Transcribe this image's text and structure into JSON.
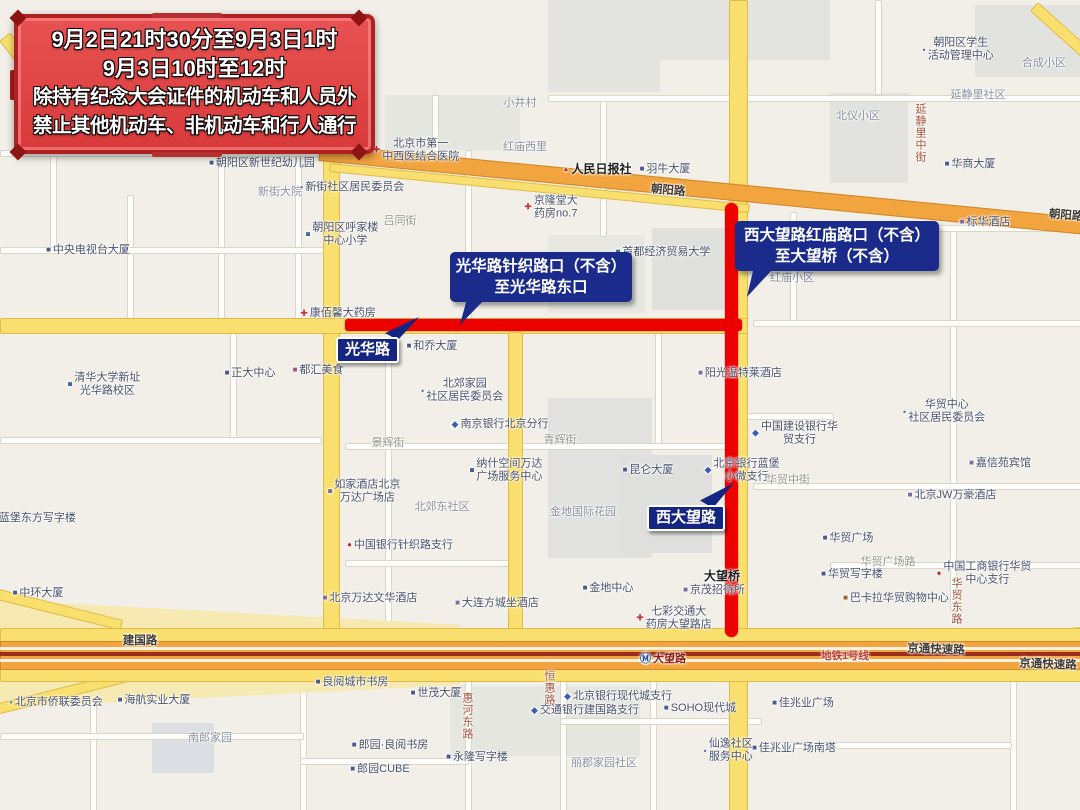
{
  "banner": {
    "lines": [
      "9月2日21时30分至9月3日1时",
      "9月3日10时至12时",
      "除持有纪念大会证件的机动车和人员外",
      "禁止其他机动车、非机动车和行人通行"
    ]
  },
  "callouts": [
    {
      "lines": [
        "光华路针织路口（不含）",
        "至光华路东口"
      ]
    },
    {
      "lines": [
        "西大望路红庙路口（不含）",
        "至大望桥（不含）"
      ]
    }
  ],
  "road_badges": [
    {
      "label": "光华路"
    },
    {
      "label": "西大望路"
    }
  ],
  "colors": {
    "restriction_red": "#EC0000",
    "callout_blue": "#1A2B8C",
    "banner_fill": "#DF4343",
    "banner_frame": "#B02222",
    "road_yellow": "#F9DF6E",
    "road_orange": "#F2A43F",
    "subway_line_red": "#9B2D1F"
  },
  "map": {
    "labels": [
      {
        "text": "朝阳区新世纪幼儿园",
        "x": 262,
        "y": 163,
        "type": "poi",
        "icon": "building"
      },
      {
        "text": "新街大院",
        "x": 280,
        "y": 192,
        "type": "area"
      },
      {
        "text": "新街社区居民委员会",
        "x": 352,
        "y": 187,
        "type": "poi",
        "icon": "dot"
      },
      {
        "text": "中央电视台大厦",
        "x": 88,
        "y": 250,
        "type": "poi",
        "icon": "building"
      },
      {
        "text": "朝阳区呼家楼\n中心小学",
        "x": 342,
        "y": 234,
        "type": "poi",
        "icon": "school"
      },
      {
        "text": "吕同街",
        "x": 400,
        "y": 221,
        "type": "roadgray"
      },
      {
        "text": "北京市第一\n中西医结合医院",
        "x": 416,
        "y": 150,
        "type": "poi",
        "icon": "hospital"
      },
      {
        "text": "红庙西里",
        "x": 525,
        "y": 147,
        "type": "area"
      },
      {
        "text": "小井村",
        "x": 520,
        "y": 103,
        "type": "area"
      },
      {
        "text": "京隆堂大\n药房no.7",
        "x": 551,
        "y": 207,
        "type": "poi",
        "icon": "pharmacy"
      },
      {
        "text": "人民日报社",
        "x": 597,
        "y": 169,
        "type": "bold",
        "icon": "flag"
      },
      {
        "text": "羽牛大厦",
        "x": 665,
        "y": 169,
        "type": "poi",
        "icon": "building"
      },
      {
        "text": "朝阳路",
        "x": 668,
        "y": 191,
        "type": "roadblack",
        "rotate": 5
      },
      {
        "text": "朝阳路",
        "x": 1066,
        "y": 216,
        "type": "roadblack",
        "rotate": 5
      },
      {
        "text": "朝阳区学生\n活动管理中心",
        "x": 958,
        "y": 49,
        "type": "poi",
        "icon": "dot"
      },
      {
        "text": "合成小区",
        "x": 1044,
        "y": 63,
        "type": "area"
      },
      {
        "text": "延静里社区",
        "x": 978,
        "y": 95,
        "type": "area"
      },
      {
        "text": "北仪小区",
        "x": 858,
        "y": 116,
        "type": "area"
      },
      {
        "text": "延静里中街",
        "x": 920,
        "y": 133,
        "type": "roadbrown",
        "vertical": true
      },
      {
        "text": "华商大厦",
        "x": 970,
        "y": 164,
        "type": "poi",
        "icon": "building"
      },
      {
        "text": "标华酒店",
        "x": 985,
        "y": 222,
        "type": "poi",
        "icon": "hotel"
      },
      {
        "text": "首都经济贸易大学",
        "x": 663,
        "y": 252,
        "type": "poi",
        "icon": "school"
      },
      {
        "text": "红庙小区",
        "x": 792,
        "y": 278,
        "type": "area"
      },
      {
        "text": "康佰馨大药房",
        "x": 338,
        "y": 313,
        "type": "poi",
        "icon": "pharmacy"
      },
      {
        "text": "和乔大厦",
        "x": 432,
        "y": 346,
        "type": "poi",
        "icon": "building"
      },
      {
        "text": "都汇美食",
        "x": 318,
        "y": 370,
        "type": "poi",
        "icon": "food"
      },
      {
        "text": "正大中心",
        "x": 250,
        "y": 373,
        "type": "poi",
        "icon": "building"
      },
      {
        "text": "清华大学新址\n光华路校区",
        "x": 104,
        "y": 384,
        "type": "poi",
        "icon": "school"
      },
      {
        "text": "蓝堡东方写字楼",
        "x": 34,
        "y": 518,
        "type": "poi",
        "icon": "building"
      },
      {
        "text": "中环大厦",
        "x": 38,
        "y": 593,
        "type": "poi",
        "icon": "building"
      },
      {
        "text": "北郊家园\n社区居民委员会",
        "x": 462,
        "y": 390,
        "type": "poi",
        "icon": "dot"
      },
      {
        "text": "南京银行北京分行",
        "x": 500,
        "y": 424,
        "type": "poi",
        "icon": "bank-blue"
      },
      {
        "text": "景辉街",
        "x": 388,
        "y": 443,
        "type": "roadgray"
      },
      {
        "text": "青辉街",
        "x": 560,
        "y": 440,
        "type": "roadgray"
      },
      {
        "text": "纳什空间万达\n广场服务中心",
        "x": 506,
        "y": 470,
        "type": "poi",
        "icon": "building"
      },
      {
        "text": "如家酒店北京\n万达广场店",
        "x": 364,
        "y": 491,
        "type": "poi",
        "icon": "hotel"
      },
      {
        "text": "北郊东社区",
        "x": 442,
        "y": 507,
        "type": "area"
      },
      {
        "text": "中国银行针织路支行",
        "x": 400,
        "y": 545,
        "type": "poi",
        "icon": "bank-red"
      },
      {
        "text": "北京万达文华酒店",
        "x": 370,
        "y": 598,
        "type": "poi",
        "icon": "hotel"
      },
      {
        "text": "大连方城坐酒店",
        "x": 497,
        "y": 603,
        "type": "poi",
        "icon": "hotel"
      },
      {
        "text": "金地国际花园",
        "x": 583,
        "y": 512,
        "type": "area"
      },
      {
        "text": "金地中心",
        "x": 608,
        "y": 588,
        "type": "poi",
        "icon": "building"
      },
      {
        "text": "昆仑大厦",
        "x": 648,
        "y": 470,
        "type": "poi",
        "icon": "building"
      },
      {
        "text": "阳光温特莱酒店",
        "x": 740,
        "y": 373,
        "type": "poi",
        "icon": "hotel"
      },
      {
        "text": "中国建设银行华\n贸支行",
        "x": 795,
        "y": 433,
        "type": "poi",
        "icon": "bank-blue"
      },
      {
        "text": "北京银行蓝堡\n小微支行",
        "x": 742,
        "y": 470,
        "type": "poi",
        "icon": "bank-blue"
      },
      {
        "text": "华贸中街",
        "x": 788,
        "y": 480,
        "type": "roadgray"
      },
      {
        "text": "华贸中心\n社区居民委员会",
        "x": 944,
        "y": 411,
        "type": "poi",
        "icon": "dot"
      },
      {
        "text": "嘉信苑宾馆",
        "x": 1000,
        "y": 463,
        "type": "poi",
        "icon": "hotel"
      },
      {
        "text": "北京JW万豪酒店",
        "x": 952,
        "y": 495,
        "type": "poi",
        "icon": "hotel"
      },
      {
        "text": "华贸广场",
        "x": 848,
        "y": 538,
        "type": "poi",
        "icon": "building"
      },
      {
        "text": "华贸写字楼",
        "x": 852,
        "y": 574,
        "type": "poi",
        "icon": "building"
      },
      {
        "text": "华贸广场路",
        "x": 888,
        "y": 562,
        "type": "roadgray"
      },
      {
        "text": "中国工商银行华贸\n中心支行",
        "x": 984,
        "y": 573,
        "type": "poi",
        "icon": "bank-red"
      },
      {
        "text": "巴卡拉华贸购物中心",
        "x": 896,
        "y": 598,
        "type": "poi",
        "icon": "shop"
      },
      {
        "text": "华贸东路",
        "x": 956,
        "y": 601,
        "type": "roadbrown",
        "vertical": true
      },
      {
        "text": "大望桥",
        "x": 722,
        "y": 576,
        "type": "bold"
      },
      {
        "text": "京茂招待所",
        "x": 714,
        "y": 590,
        "type": "poi",
        "icon": "hotel"
      },
      {
        "text": "七彩交通大\n药房大望路店",
        "x": 674,
        "y": 618,
        "type": "poi",
        "icon": "pharmacy"
      },
      {
        "text": "建国路",
        "x": 140,
        "y": 641,
        "type": "roadblack"
      },
      {
        "text": "大望路",
        "x": 663,
        "y": 659,
        "type": "subway",
        "icon": "metro"
      },
      {
        "text": "地铁1号线",
        "x": 845,
        "y": 656,
        "type": "subwayred"
      },
      {
        "text": "京通快速路",
        "x": 936,
        "y": 650,
        "type": "roadblack",
        "rotate": 2
      },
      {
        "text": "京通快速路",
        "x": 1048,
        "y": 665,
        "type": "roadblack",
        "rotate": 2
      },
      {
        "text": "北京市侨联委员会",
        "x": 56,
        "y": 702,
        "type": "poi",
        "icon": "dot"
      },
      {
        "text": "海航实业大厦",
        "x": 154,
        "y": 700,
        "type": "poi",
        "icon": "building"
      },
      {
        "text": "良阅城市书房",
        "x": 352,
        "y": 682,
        "type": "poi",
        "icon": "building"
      },
      {
        "text": "世茂大厦",
        "x": 436,
        "y": 693,
        "type": "poi",
        "icon": "building"
      },
      {
        "text": "惠河东路",
        "x": 467,
        "y": 716,
        "type": "roadbrown",
        "vertical": true
      },
      {
        "text": "恒惠路",
        "x": 549,
        "y": 688,
        "type": "roadbrown",
        "vertical": true
      },
      {
        "text": "永隆写字楼",
        "x": 477,
        "y": 757,
        "type": "poi",
        "icon": "building"
      },
      {
        "text": "郎园·良阅书房",
        "x": 390,
        "y": 745,
        "type": "poi",
        "icon": "building"
      },
      {
        "text": "郎园CUBE",
        "x": 380,
        "y": 769,
        "type": "poi",
        "icon": "building"
      },
      {
        "text": "南郎家园",
        "x": 210,
        "y": 738,
        "type": "area"
      },
      {
        "text": "北京银行现代城支行",
        "x": 618,
        "y": 696,
        "type": "poi",
        "icon": "bank-blue"
      },
      {
        "text": "交通银行建国路支行",
        "x": 585,
        "y": 710,
        "type": "poi",
        "icon": "bank-blue"
      },
      {
        "text": "丽郡家园社区",
        "x": 604,
        "y": 763,
        "type": "area"
      },
      {
        "text": "SOHO现代城",
        "x": 700,
        "y": 708,
        "type": "poi",
        "icon": "building"
      },
      {
        "text": "佳兆业广场",
        "x": 803,
        "y": 703,
        "type": "poi",
        "icon": "building"
      },
      {
        "text": "佳兆业广场南塔",
        "x": 794,
        "y": 748,
        "type": "poi",
        "icon": "building"
      },
      {
        "text": "仙逸社区\n服务中心",
        "x": 728,
        "y": 750,
        "type": "poi",
        "icon": "dot"
      }
    ]
  }
}
